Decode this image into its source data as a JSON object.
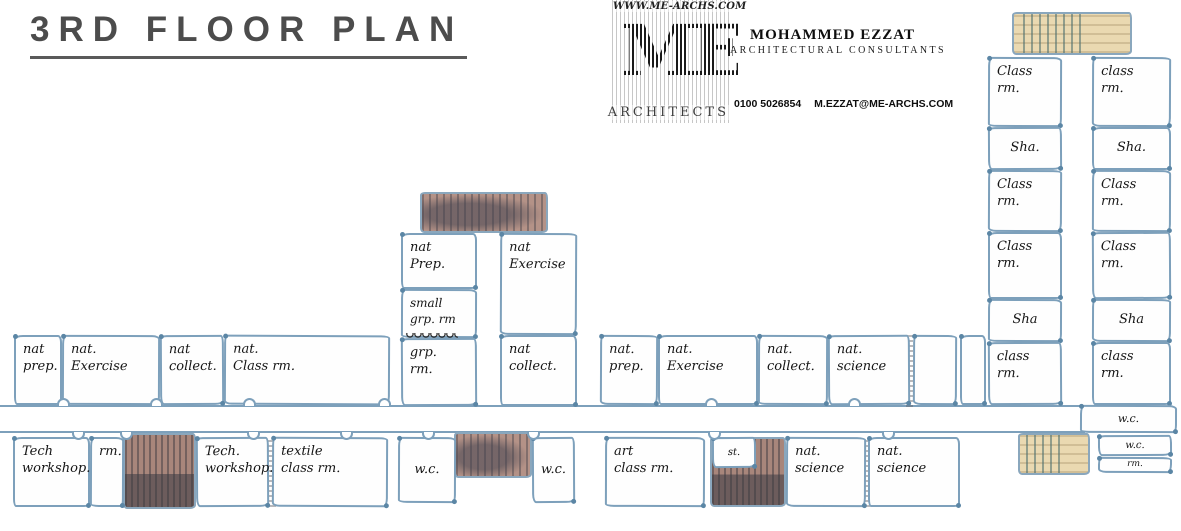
{
  "header": {
    "title": "3RD FLOOR PLAN"
  },
  "logo": {
    "website": "WWW.ME-ARCHS.COM",
    "monogram": "ME",
    "firm_label": "ARCHITECTS",
    "architect_name": "MOHAMMED EZZAT",
    "architect_subtitle": "ARCHITECTURAL CONSULTANTS",
    "phone": "0100 5026854",
    "email": "M.EZZAT@ME-ARCHS.COM"
  },
  "plan": {
    "wall_color": "#7da0bb",
    "ink_color": "#151515",
    "stair_tan_color": "#ead9b1",
    "stair_mauve_color": "#b49287",
    "corridors": [
      {
        "name": "main-corridor",
        "x": 0,
        "y": 405,
        "w": 1085,
        "h": 28
      }
    ],
    "stairs": [
      {
        "name": "stairs-northeast",
        "variant": "tan",
        "x": 1012,
        "y": 12,
        "w": 120,
        "h": 43
      },
      {
        "name": "stairs-southeast",
        "variant": "tan",
        "x": 1018,
        "y": 433,
        "w": 72,
        "h": 42
      },
      {
        "name": "stairs-center-north",
        "variant": "mauve",
        "x": 420,
        "y": 192,
        "w": 128,
        "h": 41
      },
      {
        "name": "stairs-center-south",
        "variant": "mauve",
        "x": 454,
        "y": 432,
        "w": 78,
        "h": 46
      },
      {
        "name": "stairs-southwest",
        "variant": "mauve-dark",
        "x": 123,
        "y": 433,
        "w": 73,
        "h": 76
      },
      {
        "name": "stairs-south-mid",
        "variant": "mauve-dark",
        "x": 710,
        "y": 437,
        "w": 76,
        "h": 70
      }
    ],
    "dividers": [
      {
        "name": "pencil-divider-west",
        "x": 268,
        "y": 437,
        "w": 8,
        "h": 70
      },
      {
        "name": "pencil-divider-south",
        "x": 863,
        "y": 437,
        "w": 7,
        "h": 70
      },
      {
        "name": "pencil-divider-mid",
        "x": 906,
        "y": 335,
        "w": 7,
        "h": 72
      }
    ],
    "doors": [
      {
        "x": 57,
        "y": 398,
        "dir": "up"
      },
      {
        "x": 150,
        "y": 398,
        "dir": "up"
      },
      {
        "x": 243,
        "y": 398,
        "dir": "up"
      },
      {
        "x": 378,
        "y": 398,
        "dir": "up"
      },
      {
        "x": 705,
        "y": 398,
        "dir": "up"
      },
      {
        "x": 848,
        "y": 398,
        "dir": "up"
      },
      {
        "x": 72,
        "y": 432,
        "dir": "down"
      },
      {
        "x": 120,
        "y": 432,
        "dir": "down"
      },
      {
        "x": 247,
        "y": 432,
        "dir": "down"
      },
      {
        "x": 340,
        "y": 432,
        "dir": "down"
      },
      {
        "x": 422,
        "y": 432,
        "dir": "down"
      },
      {
        "x": 527,
        "y": 432,
        "dir": "down"
      },
      {
        "x": 708,
        "y": 432,
        "dir": "down"
      },
      {
        "x": 882,
        "y": 432,
        "dir": "down"
      }
    ],
    "rooms": [
      {
        "name": "room-nat-prep-west",
        "label": "nat\nprep.",
        "x": 14,
        "y": 335,
        "w": 48,
        "h": 70
      },
      {
        "name": "room-nat-exercise-west",
        "label": "nat.\nExercise",
        "x": 62,
        "y": 335,
        "w": 98,
        "h": 70
      },
      {
        "name": "room-nat-collect-west",
        "label": "nat\ncollect.",
        "x": 160,
        "y": 335,
        "w": 64,
        "h": 70
      },
      {
        "name": "room-nat-class-rm-west",
        "label": "nat.\nClass rm.",
        "x": 224,
        "y": 335,
        "w": 166,
        "h": 70
      },
      {
        "name": "room-tech-workshop-west",
        "label": "Tech\nworkshop.",
        "x": 13,
        "y": 437,
        "w": 77,
        "h": 70
      },
      {
        "name": "room-rm-west",
        "label": "rm.",
        "x": 90,
        "y": 437,
        "w": 34,
        "h": 70
      },
      {
        "name": "room-tech-workshop-mid",
        "label": "Tech.\nworkshop.",
        "x": 196,
        "y": 437,
        "w": 73,
        "h": 70
      },
      {
        "name": "room-textile-class-rm",
        "label": "textile\nclass rm.",
        "x": 272,
        "y": 437,
        "w": 116,
        "h": 70
      },
      {
        "name": "room-nat-prep-tower",
        "label": "nat\nPrep.",
        "x": 401,
        "y": 233,
        "w": 76,
        "h": 56
      },
      {
        "name": "room-small-grp-rm",
        "label": "small\ngrp. rm",
        "x": 401,
        "y": 289,
        "w": 76,
        "h": 49,
        "fs": 12,
        "squiggle": true
      },
      {
        "name": "room-grp-rm",
        "label": "grp.\nrm.",
        "x": 401,
        "y": 338,
        "w": 76,
        "h": 68
      },
      {
        "name": "room-nat-exercise-tower",
        "label": "nat\nExercise",
        "x": 500,
        "y": 233,
        "w": 77,
        "h": 102
      },
      {
        "name": "room-nat-collect-tower",
        "label": "nat\ncollect.",
        "x": 500,
        "y": 335,
        "w": 77,
        "h": 71
      },
      {
        "name": "room-wc-center-west",
        "label": "w.c.",
        "x": 398,
        "y": 437,
        "w": 58,
        "h": 66,
        "center": true
      },
      {
        "name": "room-wc-center-east",
        "label": "w.c.",
        "x": 532,
        "y": 437,
        "w": 43,
        "h": 66,
        "center": true
      },
      {
        "name": "room-nat-prep-mid",
        "label": "nat.\nprep.",
        "x": 600,
        "y": 335,
        "w": 58,
        "h": 70
      },
      {
        "name": "room-nat-exercise-mid",
        "label": "nat.\nExercise",
        "x": 658,
        "y": 335,
        "w": 100,
        "h": 70
      },
      {
        "name": "room-nat-collect-mid",
        "label": "nat.\ncollect.",
        "x": 758,
        "y": 335,
        "w": 70,
        "h": 70
      },
      {
        "name": "room-nat-science-mid",
        "label": "nat.\nscience",
        "x": 828,
        "y": 335,
        "w": 82,
        "h": 70
      },
      {
        "name": "room-unlabeled-1",
        "label": "",
        "x": 913,
        "y": 335,
        "w": 44,
        "h": 70
      },
      {
        "name": "room-unlabeled-2",
        "label": "",
        "x": 960,
        "y": 335,
        "w": 26,
        "h": 70
      },
      {
        "name": "room-art-class-rm",
        "label": "art\nclass rm.",
        "x": 605,
        "y": 437,
        "w": 100,
        "h": 70
      },
      {
        "name": "room-st",
        "label": "st.",
        "x": 712,
        "y": 437,
        "w": 44,
        "h": 31,
        "fs": 10,
        "center": true
      },
      {
        "name": "room-nat-science-south-1",
        "label": "nat.\nscience",
        "x": 786,
        "y": 437,
        "w": 80,
        "h": 70
      },
      {
        "name": "room-nat-science-south-2",
        "label": "nat.\nscience",
        "x": 868,
        "y": 437,
        "w": 92,
        "h": 70
      },
      {
        "name": "room-class-rm-e1",
        "label": "Class\nrm.",
        "x": 988,
        "y": 57,
        "w": 74,
        "h": 70
      },
      {
        "name": "room-sha-e1",
        "label": "Sha.",
        "x": 988,
        "y": 127,
        "w": 74,
        "h": 43,
        "center": true
      },
      {
        "name": "room-class-rm-e2",
        "label": "Class\nrm.",
        "x": 988,
        "y": 170,
        "w": 74,
        "h": 62
      },
      {
        "name": "room-class-rm-e3",
        "label": "Class\nrm.",
        "x": 988,
        "y": 232,
        "w": 74,
        "h": 67
      },
      {
        "name": "room-sha-e2",
        "label": "Sha",
        "x": 988,
        "y": 299,
        "w": 74,
        "h": 43,
        "center": true
      },
      {
        "name": "room-class-rm-e4",
        "label": "class\nrm.",
        "x": 988,
        "y": 342,
        "w": 74,
        "h": 63
      },
      {
        "name": "room-class-rm-e5",
        "label": "class\nrm.",
        "x": 1092,
        "y": 57,
        "w": 79,
        "h": 70
      },
      {
        "name": "room-sha-e3",
        "label": "Sha.",
        "x": 1092,
        "y": 127,
        "w": 79,
        "h": 43,
        "center": true
      },
      {
        "name": "room-class-rm-e6",
        "label": "Class\nrm.",
        "x": 1092,
        "y": 170,
        "w": 79,
        "h": 62
      },
      {
        "name": "room-class-rm-e7",
        "label": "Class\nrm.",
        "x": 1092,
        "y": 232,
        "w": 79,
        "h": 67
      },
      {
        "name": "room-sha-e4",
        "label": "Sha",
        "x": 1092,
        "y": 299,
        "w": 79,
        "h": 43,
        "center": true
      },
      {
        "name": "room-class-rm-e8",
        "label": "class\nrm.",
        "x": 1092,
        "y": 342,
        "w": 79,
        "h": 63
      },
      {
        "name": "room-wc-east-1",
        "label": "w.c.",
        "x": 1080,
        "y": 405,
        "w": 97,
        "h": 28,
        "fs": 11,
        "center": true
      },
      {
        "name": "room-wc-east-2",
        "label": "w.c.",
        "x": 1098,
        "y": 435,
        "w": 74,
        "h": 21,
        "fs": 10,
        "center": true
      },
      {
        "name": "room-rm-east",
        "label": "rm.",
        "x": 1098,
        "y": 457,
        "w": 74,
        "h": 16,
        "fs": 9,
        "center": true
      }
    ]
  }
}
